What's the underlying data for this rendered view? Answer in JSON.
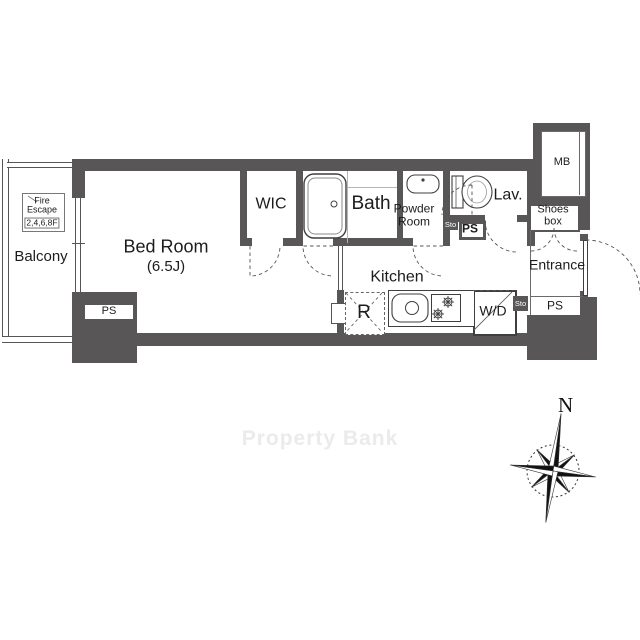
{
  "plan_title": "One-room apartment floor plan",
  "rooms": {
    "balcony": "Balcony",
    "bed_room": "Bed Room",
    "bed_room_size": "(6.5J)",
    "wic": "WIC",
    "bath": "Bath",
    "powder_room_line1": "Powder",
    "powder_room_line2": "Room",
    "lavatory": "Lav.",
    "kitchen": "Kitchen",
    "refrigerator": "R",
    "washer_dryer": "W/D",
    "entrance": "Entrance",
    "shoes_box_line1": "Shoes",
    "shoes_box_line2": "box",
    "meter_box": "MB"
  },
  "labels": {
    "ps": "PS",
    "sto": "Sto"
  },
  "fire_escape": {
    "line1": "Fire",
    "line2": "Escape",
    "floors": "2,4,6,8F"
  },
  "compass": {
    "north_label": "N"
  },
  "watermark": "Property Bank",
  "colors": {
    "wall": "#585656",
    "line": "#3a3a3a",
    "light_line": "#b5b5b5",
    "watermark": "#ebebeb"
  }
}
